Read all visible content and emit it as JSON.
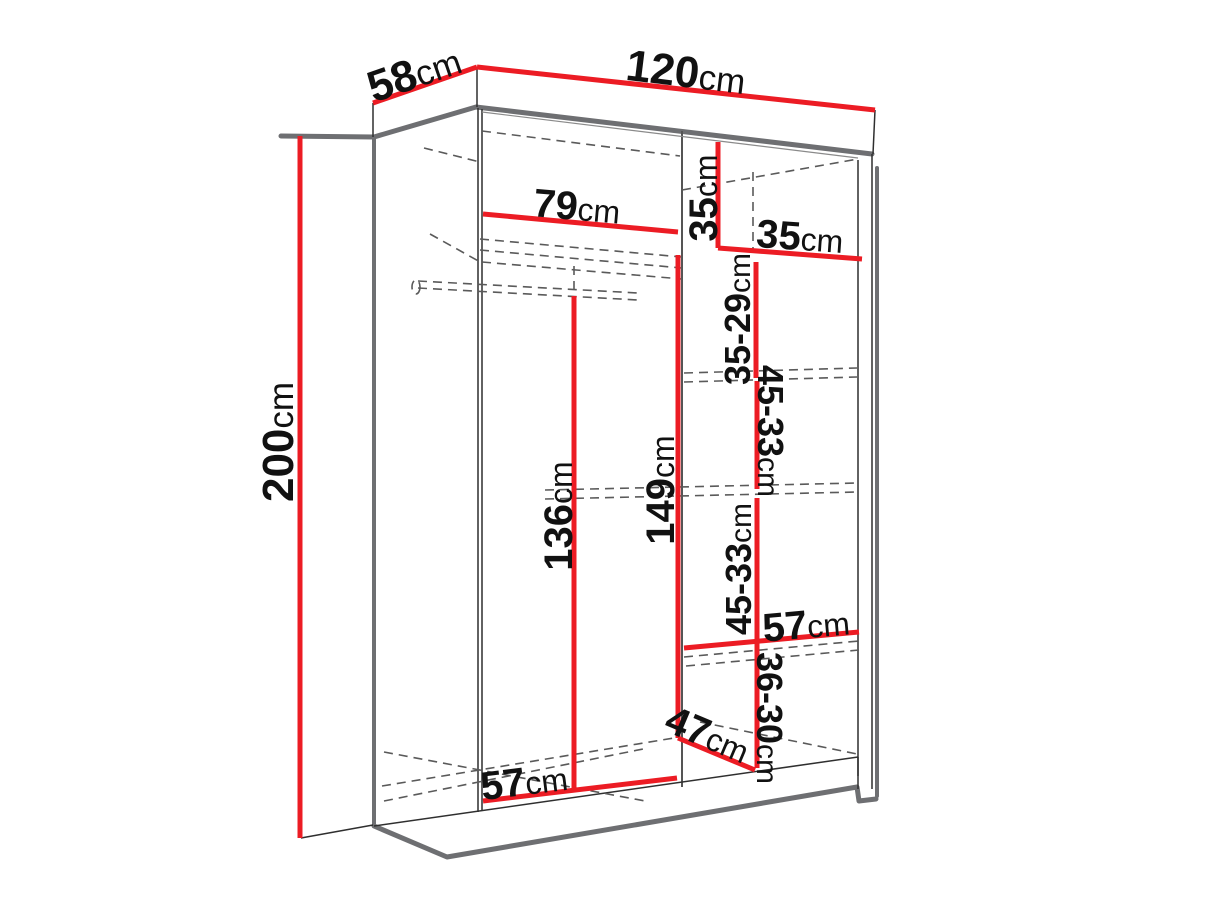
{
  "diagram": {
    "name": "wardrobe-dimension-drawing",
    "unit": "cm",
    "colors": {
      "dimension_line": "#EC1C24",
      "structure_edge": "#6E6F72",
      "dashed_line": "#5A5A5A",
      "label_text": "#111111",
      "background": "#ffffff"
    },
    "dimensions": {
      "width": {
        "value": "120",
        "unit": "cm"
      },
      "depth": {
        "value": "58",
        "unit": "cm"
      },
      "height": {
        "value": "200",
        "unit": "cm"
      },
      "left_shelf_width": {
        "value": "79",
        "unit": "cm"
      },
      "top_cubby_height": {
        "value": "35",
        "unit": "cm"
      },
      "top_cubby_width": {
        "value": "35",
        "unit": "cm"
      },
      "right_section_1_height": {
        "value": "35-29",
        "unit": "cm"
      },
      "right_section_2_height": {
        "value": "45-33",
        "unit": "cm"
      },
      "left_hanging_height": {
        "value": "136",
        "unit": "cm"
      },
      "center_hanging_height": {
        "value": "149",
        "unit": "cm"
      },
      "right_section_3_height": {
        "value": "45-33",
        "unit": "cm"
      },
      "right_shelf_width": {
        "value": "57",
        "unit": "cm"
      },
      "right_section_4_height": {
        "value": "36-30",
        "unit": "cm"
      },
      "bottom_shelf_depth": {
        "value": "47",
        "unit": "cm"
      },
      "bottom_shelf_width": {
        "value": "57",
        "unit": "cm"
      }
    }
  }
}
